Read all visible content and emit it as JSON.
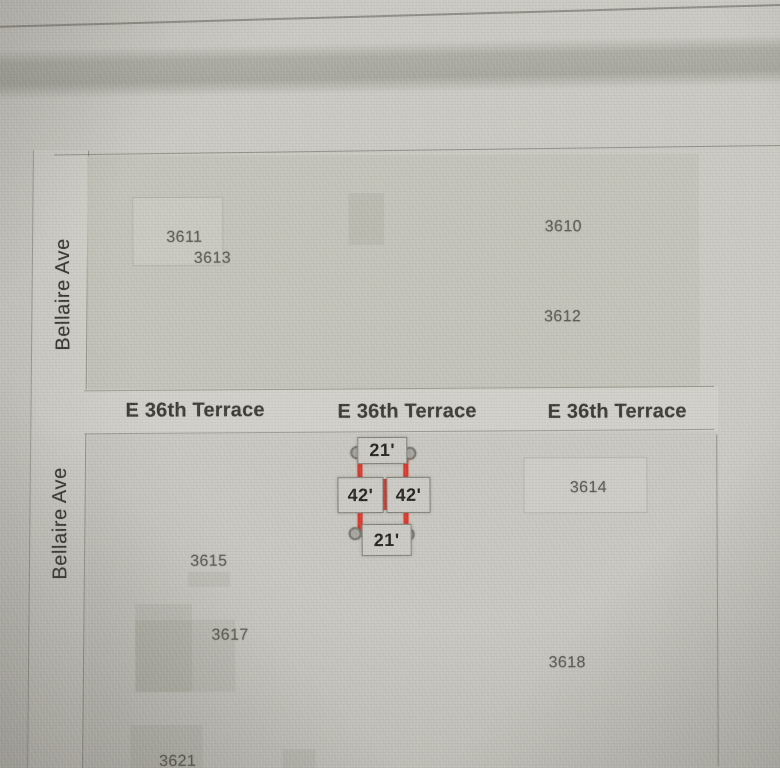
{
  "map": {
    "streets": {
      "bellaire_upper": "Bellaire Ave",
      "bellaire_lower": "Bellaire Ave",
      "e36th_left": "E 36th Terrace",
      "e36th_center": "E 36th Terrace",
      "e36th_right": "E 36th Terrace"
    },
    "parcels": {
      "p3611": "3611",
      "p3613": "3613",
      "p3610": "3610",
      "p3612": "3612",
      "p3614": "3614",
      "p3615": "3615",
      "p3617": "3617",
      "p3618": "3618",
      "p3621": "3621"
    },
    "selection": {
      "dim_top": "21'",
      "dim_left": "42'",
      "dim_right": "42'",
      "dim_bottom": "21'"
    },
    "colors": {
      "map_background": "#c9c8c1",
      "block_fill_north": "#c3c2b9",
      "block_fill_south": "#c7c6bf",
      "street_fill": "#cfcec7",
      "boundary_line": "#69685f",
      "street_text": "#3b3a34",
      "parcel_text": "#5b5a52",
      "selection_red": "#d7392e",
      "handle_gray": "#a5a49d",
      "dimension_box": "#cac9c3",
      "dimension_text": "#23231f",
      "top_bar": "#888779"
    }
  }
}
